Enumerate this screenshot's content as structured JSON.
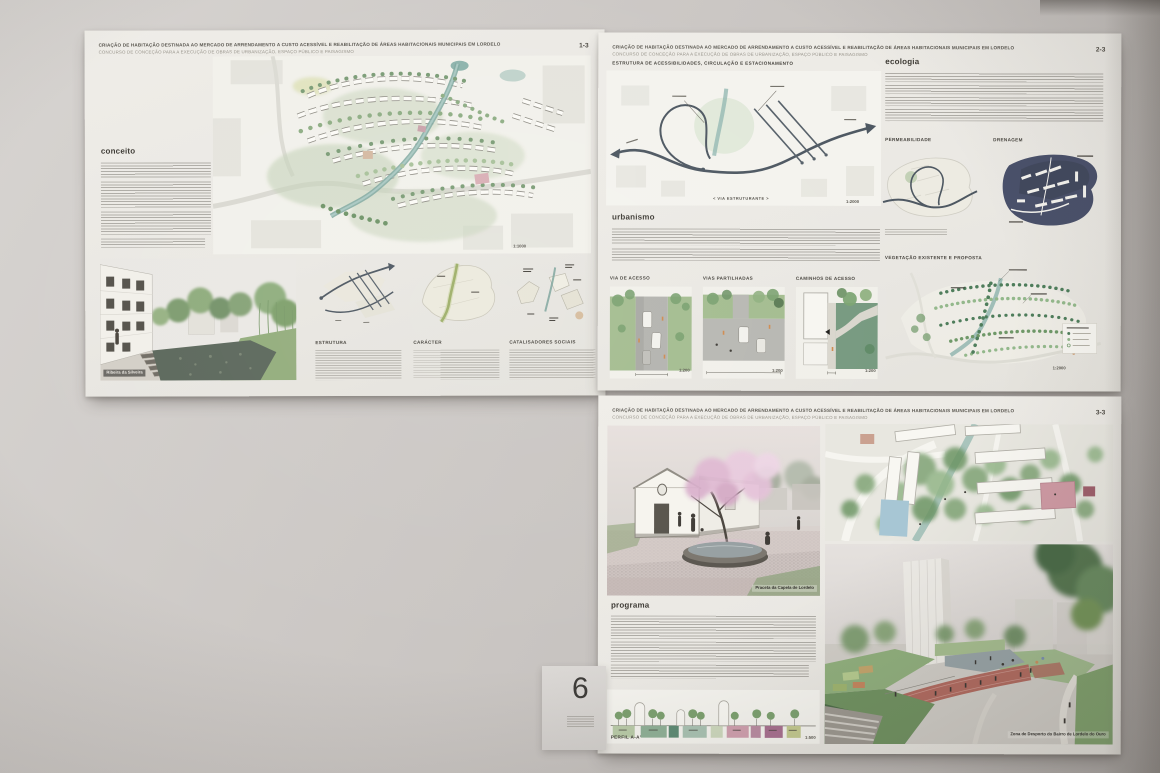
{
  "exhibit": {
    "wall_label": "6",
    "title_line1": "CRIAÇÃO DE HABITAÇÃO DESTINADA AO MERCADO DE ARRENDAMENTO A CUSTO ACESSÍVEL E REABILITAÇÃO DE ÁREAS HABITACIONAIS MUNICIPAIS EM LORDELO",
    "title_line2": "CONCURSO DE CONCEÇÃO PARA A EXECUÇÃO DE OBRAS DE URBANIZAÇÃO, ESPAÇO PÚBLICO E PAISAGISMO"
  },
  "panel1": {
    "page_number": "1-3",
    "concept_heading": "conceito",
    "plan_scale": "1:1000",
    "render_caption": "Ribeira da Silveira",
    "columns": [
      {
        "heading": "ESTRUTURA"
      },
      {
        "heading": "CARÁCTER"
      },
      {
        "heading": "CATALISADORES SOCIAIS"
      }
    ]
  },
  "panel2": {
    "page_number": "2-3",
    "access_heading": "ESTRUTURA DE ACESSIBILIDADES, CIRCULAÇÃO E ESTACIONAMENTO",
    "via_label": "< VIA ESTRUTURANTE >",
    "access_scale": "1:2000",
    "urbanism_heading": "urbanismo",
    "street_sections": [
      {
        "heading": "VIA DE ACESSO",
        "scale": "1:200"
      },
      {
        "heading": "VIAS PARTILHADAS",
        "scale": "1:200"
      },
      {
        "heading": "CAMINHOS DE ACESSO",
        "scale": "1:200"
      }
    ],
    "ecology_heading": "ecologia",
    "permeability_heading": "PERMEABILIDADE",
    "drainage_heading": "DRENAGEM",
    "vegetation_heading": "VEGETAÇÃO EXISTENTE E PROPOSTA",
    "vegetation_scale": "1:2000"
  },
  "panel3": {
    "page_number": "3-3",
    "chapel_caption": "Praceta da Capela de Lordelo",
    "program_heading": "programa",
    "profile_label": "PERFIL A-A'",
    "profile_scale": "1:500",
    "sports_caption": "Zona de Desporto do Bairro de Lordelo do Ouro"
  },
  "colors": {
    "river_teal": "#7fa8a0",
    "drainage_navy": "#49506a",
    "vegetation_green": "#4e7d5b",
    "track_red": "#ad6a60",
    "blossom_pink": "#dfb6d0",
    "wall_gray": "#c7c3c0",
    "board_white": "#eceae5"
  }
}
